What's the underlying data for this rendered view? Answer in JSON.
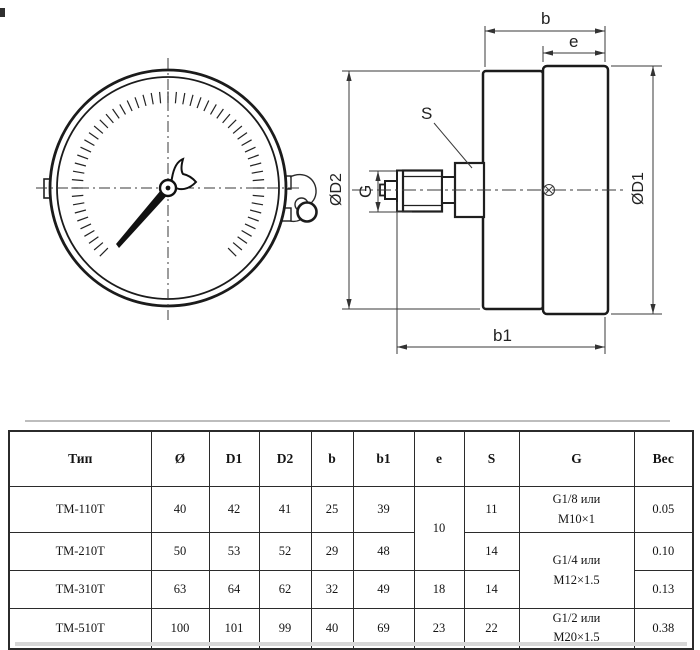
{
  "drawing": {
    "labels": {
      "b": "b",
      "e": "e",
      "s": "S",
      "g": "G",
      "b1": "b1",
      "od1": "ØD1",
      "od2": "ØD2"
    }
  },
  "table": {
    "headers": [
      "Тип",
      "Ø",
      "D1",
      "D2",
      "b",
      "b1",
      "e",
      "S",
      "G",
      "Вес"
    ],
    "rows": [
      [
        "ТМ-110Т",
        "40",
        "42",
        "41",
        "25",
        "39",
        "10",
        "11",
        "G1/8 или\nМ10×1",
        "0.05"
      ],
      [
        "ТМ-210Т",
        "50",
        "53",
        "52",
        "29",
        "48",
        "",
        "14",
        "G1/4 или\nМ12×1.5",
        "0.10"
      ],
      [
        "ТМ-310Т",
        "63",
        "64",
        "62",
        "32",
        "49",
        "18",
        "14",
        "",
        "0.13"
      ],
      [
        "ТМ-510Т",
        "100",
        "101",
        "99",
        "40",
        "69",
        "23",
        "22",
        "G1/2 или\nМ20×1.5",
        "0.38"
      ]
    ]
  }
}
